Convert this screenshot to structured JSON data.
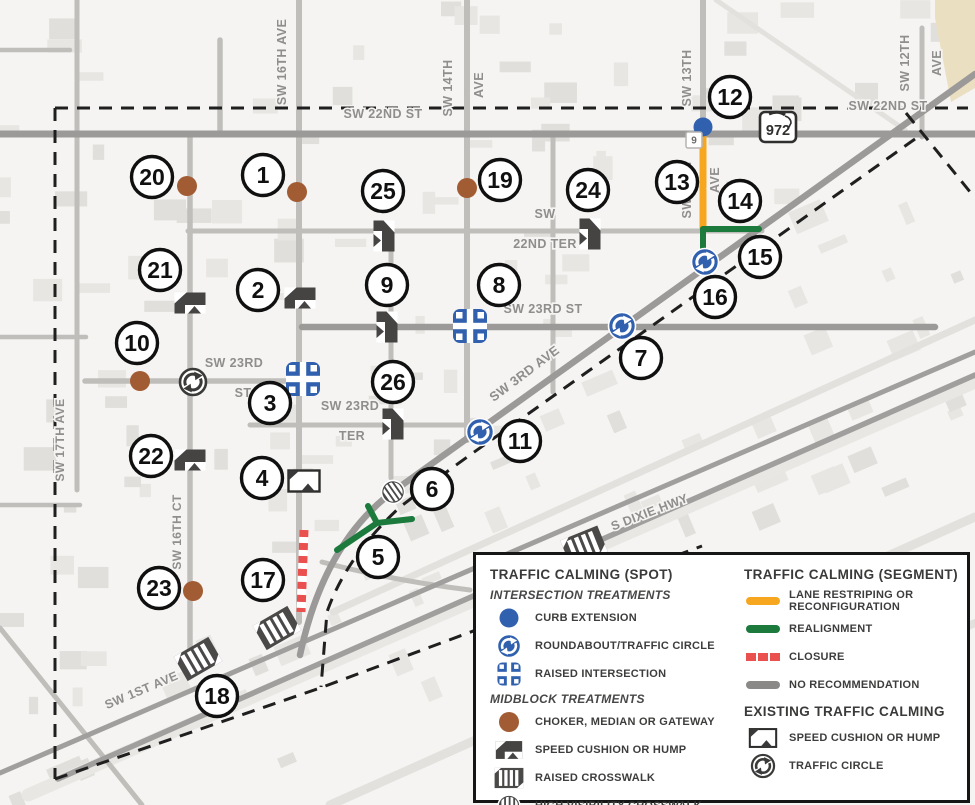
{
  "map": {
    "colors": {
      "bg": "#F5F4F2",
      "building": "#E7E6E3",
      "building2": "#E0DFDC",
      "building_tan": "#EBDFC2",
      "road_light": "#E2E1DE",
      "road_mid": "#BFBEBB",
      "road_dark": "#9B9A98",
      "road_darker": "#A09F9D",
      "band": "#E8E7E4",
      "boundary": "#1F1F1F",
      "blue": "#3161AE",
      "green": "#1B7A3C",
      "orange": "#F6A71F",
      "red": "#E9504E",
      "brown": "#A25C33",
      "icon_dark": "#454443",
      "label_gray": "#8F8E8C"
    },
    "roads": [
      {
        "d": "M28,795 L975,382",
        "w": 13,
        "c": "band"
      },
      {
        "d": "M330,805 L975,517",
        "w": 9,
        "c": "road_light"
      },
      {
        "d": "M560,805 L975,623",
        "w": 8,
        "c": "road_light"
      },
      {
        "d": "M333,612 L975,320",
        "w": 7,
        "c": "road_light"
      },
      {
        "d": "M716,0 L905,130",
        "w": 5,
        "c": "road_light"
      },
      {
        "d": "M0,628 L142,805",
        "w": 5,
        "c": "road_mid"
      },
      {
        "d": "M0,337 L86,337",
        "w": 4.5,
        "c": "road_mid"
      },
      {
        "d": "M0,505 L80,505",
        "w": 4.5,
        "c": "road_mid"
      },
      {
        "d": "M0,50 L70,50",
        "w": 4.5,
        "c": "road_mid"
      },
      {
        "d": "M77,0 L77,490",
        "w": 5,
        "c": "road_mid"
      },
      {
        "d": "M220,40 L220,134",
        "w": 5.5,
        "c": "road_mid"
      },
      {
        "d": "M190,134 L190,655",
        "w": 5.5,
        "c": "road_mid"
      },
      {
        "d": "M299,0 L299,622",
        "w": 6,
        "c": "road_mid"
      },
      {
        "d": "M391,229 L391,478",
        "w": 5,
        "c": "road_mid"
      },
      {
        "d": "M467,0 L467,440",
        "w": 6,
        "c": "road_mid"
      },
      {
        "d": "M553,133 L553,392",
        "w": 5,
        "c": "road_mid"
      },
      {
        "d": "M703,0 L703,263",
        "w": 6,
        "c": "road_mid"
      },
      {
        "d": "M922,28 L922,137",
        "w": 5,
        "c": "road_mid"
      },
      {
        "d": "M188,231 L762,231",
        "w": 5,
        "c": "road_mid"
      },
      {
        "d": "M85,381 L312,381",
        "w": 5.5,
        "c": "road_mid"
      },
      {
        "d": "M250,425 L474,425",
        "w": 5,
        "c": "road_mid"
      },
      {
        "d": "M322,562 Q390,580 470,590",
        "w": 5,
        "c": "road_mid"
      },
      {
        "d": "M58,779 L975,375",
        "w": 5.5,
        "c": "road_darker"
      },
      {
        "d": "M0,773 L975,352",
        "w": 5,
        "c": "road_darker"
      },
      {
        "d": "M300,655 C315,585 345,525 398,488 L975,74",
        "w": 6.5,
        "c": "road_dark"
      },
      {
        "d": "M0,134 L975,134",
        "w": 7,
        "c": "road_dark"
      },
      {
        "d": "M302,327 L935,327",
        "w": 6.5,
        "c": "road_dark"
      }
    ],
    "boundary_paths": [
      "M55,108 L968,108",
      "M55,108 L55,779",
      "M55,779 L320,688 L702,546",
      "M915,139 L497,436 Q448,470 400,507 Q346,557 327,612 L321,687",
      "M906,113 L975,198"
    ],
    "segments": [
      {
        "type": "closure",
        "d": "M304,530 L301,612"
      },
      {
        "type": "lane-restriping",
        "d": "M703,134 L703,229"
      },
      {
        "type": "realignment",
        "d": "M703,229 L759,229"
      },
      {
        "type": "realignment",
        "d": "M703,229 L703,251"
      },
      {
        "type": "realignment",
        "d": "M337,550 L377,523 L412,519"
      },
      {
        "type": "realignment",
        "d": "M377,523 L368,506"
      }
    ],
    "spot_icons": [
      {
        "type": "choker",
        "x": 187,
        "y": 186
      },
      {
        "type": "choker",
        "x": 297,
        "y": 192
      },
      {
        "type": "choker",
        "x": 467,
        "y": 188
      },
      {
        "type": "choker",
        "x": 140,
        "y": 381
      },
      {
        "type": "choker",
        "x": 193,
        "y": 591
      },
      {
        "type": "curb-extension",
        "x": 703,
        "y": 127
      },
      {
        "type": "roundabout",
        "x": 705,
        "y": 262
      },
      {
        "type": "roundabout",
        "x": 622,
        "y": 326
      },
      {
        "type": "roundabout",
        "x": 480,
        "y": 432
      },
      {
        "type": "raised-intersection",
        "x": 470,
        "y": 326
      },
      {
        "type": "raised-intersection",
        "x": 303,
        "y": 379
      },
      {
        "type": "speed-cushion",
        "x": 300,
        "y": 298,
        "rot": 0
      },
      {
        "type": "speed-cushion",
        "x": 190,
        "y": 303,
        "rot": 0
      },
      {
        "type": "speed-cushion",
        "x": 190,
        "y": 460,
        "rot": 0
      },
      {
        "type": "speed-cushion",
        "x": 387,
        "y": 327,
        "rot": 90
      },
      {
        "type": "speed-cushion",
        "x": 384,
        "y": 236,
        "rot": 90
      },
      {
        "type": "speed-cushion",
        "x": 590,
        "y": 234,
        "rot": 90
      },
      {
        "type": "speed-cushion",
        "x": 393,
        "y": 424,
        "rot": 90
      },
      {
        "type": "speed-cushion-existing",
        "x": 304,
        "y": 481,
        "rot": 0
      },
      {
        "type": "raised-crosswalk",
        "x": 277,
        "y": 628,
        "rot": -30
      },
      {
        "type": "raised-crosswalk",
        "x": 198,
        "y": 659,
        "rot": -30
      },
      {
        "type": "raised-crosswalk",
        "x": 584,
        "y": 546,
        "rot": -22
      },
      {
        "type": "high-visibility-crosswalk",
        "x": 393,
        "y": 492,
        "rot": -35
      },
      {
        "type": "traffic-circle-existing",
        "x": 193,
        "y": 382
      }
    ],
    "street_labels": [
      {
        "text": "SW 22ND ST",
        "x": 383,
        "y": 118,
        "rot": 0,
        "size": 12.5
      },
      {
        "text": "SW 22ND ST",
        "x": 888,
        "y": 110,
        "rot": 0,
        "size": 12.5
      },
      {
        "text": "SW 16TH AVE",
        "x": 286,
        "y": 62,
        "rot": -90,
        "size": 12.5
      },
      {
        "text": "SW 14TH",
        "x": 452,
        "y": 88,
        "rot": -90,
        "size": 12.5
      },
      {
        "text": "AVE",
        "x": 483,
        "y": 85,
        "rot": -90,
        "size": 12.5
      },
      {
        "text": "SW 13TH",
        "x": 691,
        "y": 78,
        "rot": -90,
        "size": 12.5
      },
      {
        "text": "SW 13TH",
        "x": 691,
        "y": 190,
        "rot": -90,
        "size": 12.5
      },
      {
        "text": "AVE",
        "x": 719,
        "y": 180,
        "rot": -90,
        "size": 12.5
      },
      {
        "text": "SW 12TH",
        "x": 909,
        "y": 63,
        "rot": -90,
        "size": 12.5
      },
      {
        "text": "AVE",
        "x": 941,
        "y": 63,
        "rot": -90,
        "size": 12.5
      },
      {
        "text": "SW 17TH AVE",
        "x": 64,
        "y": 440,
        "rot": -90,
        "size": 12
      },
      {
        "text": "SW 16TH CT",
        "x": 181,
        "y": 532,
        "rot": -90,
        "size": 12
      },
      {
        "text": "SW 23RD",
        "x": 234,
        "y": 367,
        "rot": 0,
        "size": 12.5
      },
      {
        "text": "ST",
        "x": 243,
        "y": 397,
        "rot": 0,
        "size": 12.5
      },
      {
        "text": "SW 23RD ST",
        "x": 543,
        "y": 313,
        "rot": 0,
        "size": 12.5
      },
      {
        "text": "SW 23RD",
        "x": 350,
        "y": 410,
        "rot": 0,
        "size": 12.5
      },
      {
        "text": "TER",
        "x": 352,
        "y": 440,
        "rot": 0,
        "size": 12.5
      },
      {
        "text": "SW",
        "x": 545,
        "y": 218,
        "rot": 0,
        "size": 12.5
      },
      {
        "text": "22ND TER",
        "x": 545,
        "y": 248,
        "rot": 0,
        "size": 12.5
      },
      {
        "text": "SW 3RD AVE",
        "x": 527,
        "y": 377,
        "rot": -37,
        "size": 13
      },
      {
        "text": "S DIXIE HWY",
        "x": 651,
        "y": 516,
        "rot": -21,
        "size": 12.5
      },
      {
        "text": "SW 1ST AVE",
        "x": 143,
        "y": 694,
        "rot": -23,
        "size": 12.5
      }
    ],
    "route_shield": {
      "text": "972",
      "x": 778,
      "y": 127
    },
    "route_shield_small": {
      "text": "9",
      "x": 694,
      "y": 140
    },
    "markers": [
      {
        "n": "1",
        "x": 263,
        "y": 175
      },
      {
        "n": "2",
        "x": 258,
        "y": 290
      },
      {
        "n": "3",
        "x": 270,
        "y": 403
      },
      {
        "n": "4",
        "x": 262,
        "y": 478
      },
      {
        "n": "5",
        "x": 378,
        "y": 557
      },
      {
        "n": "6",
        "x": 432,
        "y": 489
      },
      {
        "n": "7",
        "x": 641,
        "y": 358
      },
      {
        "n": "8",
        "x": 499,
        "y": 285
      },
      {
        "n": "9",
        "x": 387,
        "y": 285
      },
      {
        "n": "10",
        "x": 137,
        "y": 343
      },
      {
        "n": "11",
        "x": 520,
        "y": 441
      },
      {
        "n": "12",
        "x": 730,
        "y": 97
      },
      {
        "n": "13",
        "x": 677,
        "y": 182
      },
      {
        "n": "14",
        "x": 740,
        "y": 201
      },
      {
        "n": "15",
        "x": 760,
        "y": 257
      },
      {
        "n": "16",
        "x": 715,
        "y": 297
      },
      {
        "n": "17",
        "x": 263,
        "y": 580
      },
      {
        "n": "18",
        "x": 217,
        "y": 696
      },
      {
        "n": "19",
        "x": 500,
        "y": 180
      },
      {
        "n": "20",
        "x": 152,
        "y": 177
      },
      {
        "n": "21",
        "x": 160,
        "y": 270
      },
      {
        "n": "22",
        "x": 151,
        "y": 456
      },
      {
        "n": "23",
        "x": 159,
        "y": 588
      },
      {
        "n": "24",
        "x": 588,
        "y": 190
      },
      {
        "n": "25",
        "x": 383,
        "y": 191
      },
      {
        "n": "26",
        "x": 393,
        "y": 382
      }
    ]
  },
  "legend": {
    "spot": {
      "title": "TRAFFIC CALMING (SPOT)",
      "sections": [
        {
          "heading": "INTERSECTION TREATMENTS",
          "items": [
            {
              "icon": "curb-extension",
              "label": "CURB EXTENSION"
            },
            {
              "icon": "roundabout",
              "label": "ROUNDABOUT/TRAFFIC CIRCLE"
            },
            {
              "icon": "raised-intersection",
              "label": "RAISED INTERSECTION"
            }
          ]
        },
        {
          "heading": "MIDBLOCK TREATMENTS",
          "items": [
            {
              "icon": "choker",
              "label": "CHOKER, MEDIAN OR GATEWAY"
            },
            {
              "icon": "speed-cushion",
              "label": "SPEED CUSHION OR HUMP"
            },
            {
              "icon": "raised-crosswalk",
              "label": "RAISED CROSSWALK"
            },
            {
              "icon": "high-visibility-crosswalk",
              "label": "HIGH VISIBILITY CROSSWALK"
            }
          ]
        }
      ]
    },
    "segment": {
      "title": "TRAFFIC CALMING (SEGMENT)",
      "items": [
        {
          "icon": "line-orange",
          "label": "LANE RESTRIPING OR RECONFIGURATION"
        },
        {
          "icon": "line-green",
          "label": "REALIGNMENT"
        },
        {
          "icon": "line-red-dashed",
          "label": "CLOSURE"
        },
        {
          "icon": "line-gray",
          "label": "NO RECOMMENDATION"
        }
      ],
      "existing_title": "EXISTING TRAFFIC CALMING",
      "existing_items": [
        {
          "icon": "speed-cushion-existing",
          "label": "SPEED CUSHION OR HUMP"
        },
        {
          "icon": "traffic-circle-existing",
          "label": "TRAFFIC CIRCLE"
        }
      ]
    }
  }
}
